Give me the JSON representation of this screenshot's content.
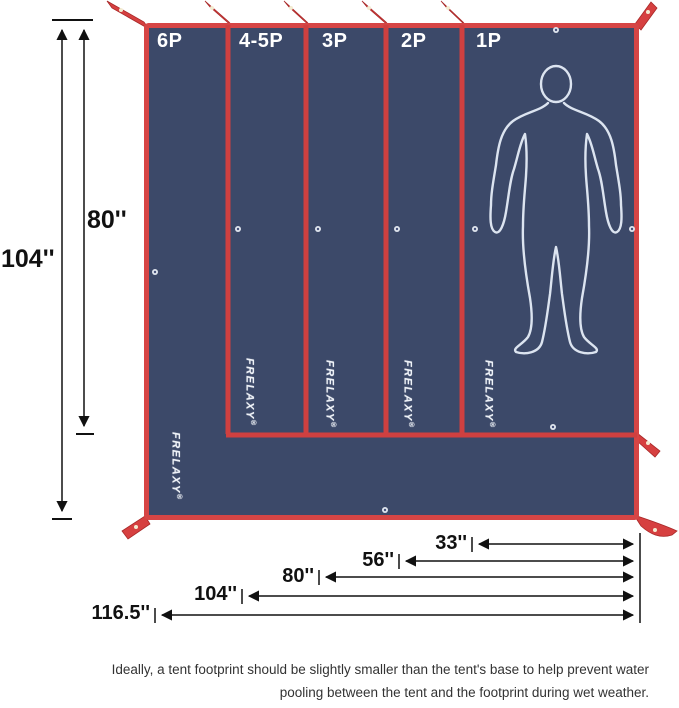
{
  "diagram": {
    "panels": [
      {
        "label": "6P"
      },
      {
        "label": "4-5P"
      },
      {
        "label": "3P"
      },
      {
        "label": "2P"
      },
      {
        "label": "1P"
      }
    ],
    "brand": {
      "name": "FRELAXY",
      "mark": "®"
    },
    "vertical_dims": [
      {
        "label": "104''"
      },
      {
        "label": "80''"
      }
    ],
    "horizontal_dims": [
      {
        "label": "33''"
      },
      {
        "label": "56''"
      },
      {
        "label": "80''"
      },
      {
        "label": "104''"
      },
      {
        "label": "116.5''"
      }
    ],
    "colors": {
      "tarp_navy": "#3c4969",
      "trim_red": "#d04343",
      "silhouette_white": "#dce4f0",
      "dimension_black": "#111111"
    }
  },
  "caption": {
    "line1": "Ideally, a tent footprint should be slightly smaller than the tent's base to help prevent water",
    "line2": "pooling between the tent and the footprint during wet weather."
  }
}
